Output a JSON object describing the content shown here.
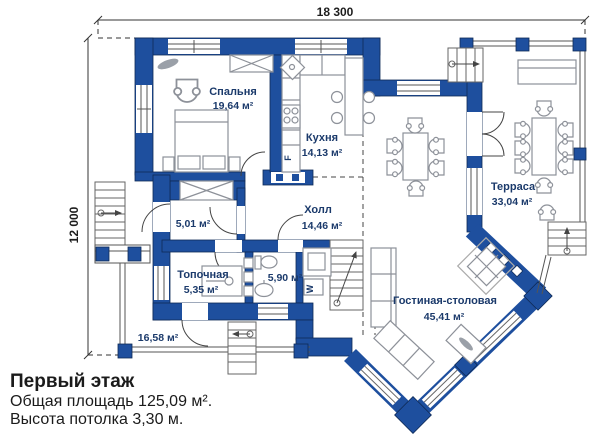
{
  "colors": {
    "wall": "#1e4f9e",
    "wall_edge": "#0e2a56",
    "label": "#1b3a6b",
    "furniture": "#8d9199",
    "line": "#444444"
  },
  "dimensions": {
    "width_label": "18 300",
    "height_label": "12 000"
  },
  "rooms": {
    "bedroom": {
      "name": "Спальня",
      "area": "19,64 м²"
    },
    "kitchen": {
      "name": "Кухня",
      "area": "14,13 м²"
    },
    "hall": {
      "name": "Холл",
      "area": "14,46 м²"
    },
    "terrace": {
      "name": "Терраса",
      "area": "33,04 м²"
    },
    "living": {
      "name": "Гостиная-столовая",
      "area": "45,41 м²"
    },
    "boiler": {
      "name": "Топочная",
      "area": "5,35 м²"
    },
    "bathroom": {
      "area": "5,90 м²"
    },
    "entry": {
      "area": "5,01 м²"
    },
    "porch": {
      "area": "16,58 м²"
    }
  },
  "appliances": {
    "fridge": "F",
    "washer": "W"
  },
  "footer": {
    "title": "Первый этаж",
    "line1": "Общая площадь 125,09 м².",
    "line2": "Высота потолка 3,30 м."
  }
}
